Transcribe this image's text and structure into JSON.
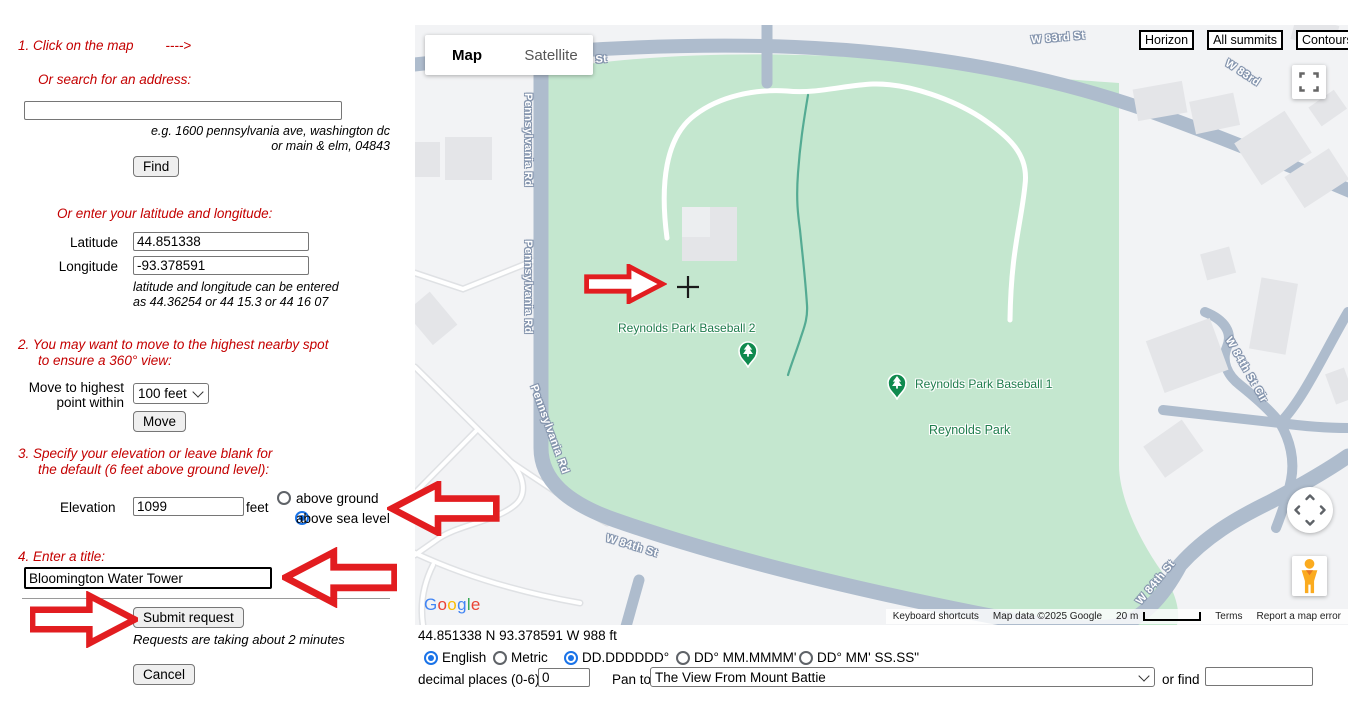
{
  "panel": {
    "step1": "1. Click on the map",
    "step1_arrow": "---->",
    "search_label": "Or search for an address:",
    "search_hint_line1": "e.g. 1600 pennsylvania ave, washington dc",
    "search_hint_line2": "or main & elm, 04843",
    "find_button": "Find",
    "latlng_label": "Or enter your latitude and longitude:",
    "latitude_label": "Latitude",
    "latitude_value": "44.851338",
    "longitude_label": "Longitude",
    "longitude_value": "-93.378591",
    "latlng_hint_line1": "latitude and longitude can be entered",
    "latlng_hint_line2": "as 44.36254 or 44 15.3 or 44 16 07",
    "step2_line1": "2. You may want to move to the highest nearby spot",
    "step2_line2": "to ensure a 360° view:",
    "move_label_line1": "Move to highest",
    "move_label_line2": "point within",
    "move_select_value": "100 feet",
    "move_button": "Move",
    "step3_line1": "3. Specify your elevation or leave blank for",
    "step3_line2": "the default (6 feet above ground level):",
    "elevation_label": "Elevation",
    "elevation_value": "1099",
    "feet_label": "feet",
    "above_ground_label": "above ground",
    "above_sea_label": "above sea level",
    "step4": "4. Enter a title:",
    "title_value": "Bloomington Water Tower",
    "submit_button": "Submit request",
    "submit_note": "Requests are taking about 2 minutes",
    "cancel_button": "Cancel"
  },
  "map": {
    "map_tab": "Map",
    "satellite_tab": "Satellite",
    "overlay_buttons": {
      "horizon": "Horizon",
      "all_summits": "All summits",
      "contours": "Contours"
    },
    "street_labels": [
      {
        "text": "W 83rd St"
      },
      {
        "text": "W 83rd St"
      },
      {
        "text": "W 83rd"
      },
      {
        "text": "Pennsylvania Rd"
      },
      {
        "text": "Pennsylvania Rd"
      },
      {
        "text": "Pennsylvania Rd"
      },
      {
        "text": "W 84th St"
      },
      {
        "text": "W 84th St Cir"
      },
      {
        "text": "W 84th St"
      }
    ],
    "poi": {
      "baseball2": "Reynolds Park Baseball 2",
      "baseball1": "Reynolds Park Baseball 1",
      "park": "Reynolds Park"
    },
    "google_logo": "Google",
    "attribution": {
      "keyboard": "Keyboard shortcuts",
      "mapdata": "Map data ©2025 Google",
      "scale": "20 m",
      "terms": "Terms",
      "report": "Report a map error"
    }
  },
  "statusbar": {
    "coords": "44.851338 N 93.378591 W 988 ft",
    "unit_english": "English",
    "unit_metric": "Metric",
    "fmt_dd": "DD.DDDDDD°",
    "fmt_dm": "DD° MM.MMMM'",
    "fmt_dms": "DD° MM' SS.SS\"",
    "decimal_label": "decimal places (0-6)",
    "decimal_value": "0",
    "panto_label": "Pan to",
    "panto_value": "The View From Mount Battie",
    "orfind_label": "or find"
  },
  "colors": {
    "instruction_red": "#c40000",
    "arrow_red": "#e21d20",
    "park_green": "#c4e7cf",
    "road_gray_blue": "#aebccd",
    "poi_green": "#1f7c4d",
    "radio_blue": "#1a73e8",
    "google_letters": [
      "#4285F4",
      "#EA4335",
      "#FBBC05",
      "#4285F4",
      "#34A853",
      "#EA4335"
    ]
  }
}
